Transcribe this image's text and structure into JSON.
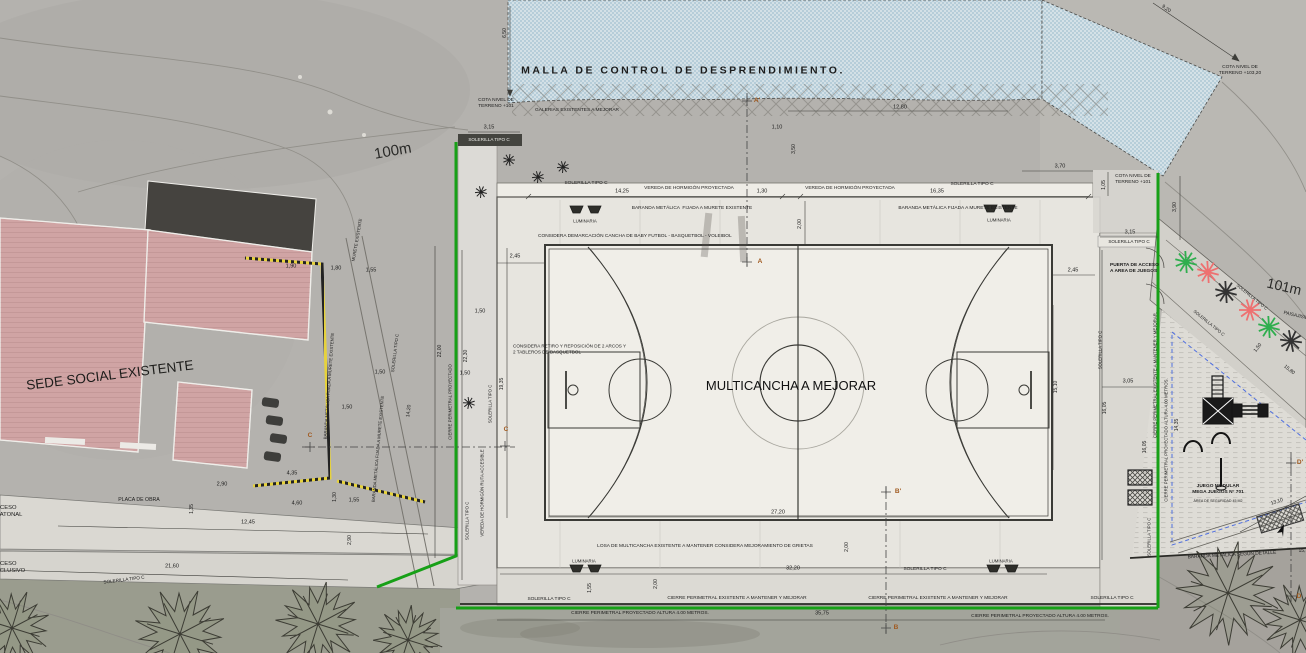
{
  "palette": {
    "background": "#b4b2ae",
    "mesh_blue": "#c6dde9",
    "gallery_orange": "#e1a544",
    "gallery_stripe": "#54431d",
    "court_surface": "#f0eee8",
    "platform": "#e7e5df",
    "concrete": "#dad8d2",
    "building_pink": "#d2a6a6",
    "roof_dark": "#45433f",
    "fence_green": "#17a017",
    "barrier_yellow": "#e6d23c",
    "safety_blue_dashed": "#4f6fe0",
    "plant_red": "#ee7070",
    "plant_green": "#2fae4e",
    "ink": "#1c1c1c",
    "section_marker": "#a05a20"
  },
  "labels": [
    {
      "id": "malla-title",
      "t": "MALLA DE CONTROL DE DESPRENDIMIENTO.",
      "x": 683,
      "y": 71,
      "s": 10.5,
      "b": 1,
      "ls": 2.5
    },
    {
      "id": "cota-terreno-101-left",
      "t": "COTA NIVEL DE\nTERRENO +101",
      "x": 496,
      "y": 104,
      "s": 4.8
    },
    {
      "id": "galerias-label",
      "t": "GALERIAS EXISTENTES A MEJORAR",
      "x": 577,
      "y": 111,
      "s": 4.8
    },
    {
      "id": "dim-3-15-left",
      "t": "3,15",
      "x": 489,
      "y": 128,
      "s": 5.5
    },
    {
      "id": "solerilla-band-top",
      "t": "SOLERILLA TIPO C",
      "x": 489,
      "y": 140,
      "s": 4.6,
      "c": "#eeeeea"
    },
    {
      "id": "dim-6-50",
      "t": "6,50",
      "x": 505,
      "y": 33,
      "r": -90,
      "s": 5
    },
    {
      "id": "dim-12-80",
      "t": "12,80",
      "x": 900,
      "y": 108,
      "s": 5.5
    },
    {
      "id": "dim-1-10",
      "t": "1,10",
      "x": 777,
      "y": 128,
      "s": 5.5
    },
    {
      "id": "dim-3-50",
      "t": "3,50",
      "x": 794,
      "y": 149,
      "r": -90,
      "s": 5
    },
    {
      "id": "solerilla-gal-left",
      "t": "SOLERILLA TIPO C",
      "x": 586,
      "y": 184,
      "s": 4.8
    },
    {
      "id": "dim-14-25",
      "t": "14,25",
      "x": 622,
      "y": 192,
      "s": 5.5
    },
    {
      "id": "vereda-left",
      "t": "VEREDA DE HORMIGÓN PROYECTADA",
      "x": 689,
      "y": 189,
      "s": 4.8
    },
    {
      "id": "dim-1-30-top",
      "t": "1,30",
      "x": 762,
      "y": 192,
      "s": 5.5
    },
    {
      "id": "vereda-right",
      "t": "VEREDA DE HORMIGÓN PROYECTADA",
      "x": 850,
      "y": 189,
      "s": 4.8
    },
    {
      "id": "dim-16-35",
      "t": "16,35",
      "x": 937,
      "y": 192,
      "s": 5.5
    },
    {
      "id": "solerilla-gal-right",
      "t": "SOLERILLA TIPO C",
      "x": 972,
      "y": 185,
      "s": 4.8
    },
    {
      "id": "dim-3-70",
      "t": "3,70",
      "x": 1060,
      "y": 167,
      "s": 5.5
    },
    {
      "id": "cota-terreno-101-right",
      "t": "COTA NIVEL DE\nTERRENO +101",
      "x": 1133,
      "y": 180,
      "s": 4.8
    },
    {
      "id": "dim-1-05",
      "t": "1,05",
      "x": 1104,
      "y": 185,
      "r": -90,
      "s": 5
    },
    {
      "id": "dim-3-90",
      "t": "3,90",
      "x": 1175,
      "y": 207,
      "r": -90,
      "s": 5
    },
    {
      "id": "cota-terreno-103",
      "t": "COTA NIVEL DE\nTERRENO +103,20",
      "x": 1240,
      "y": 71,
      "s": 4.8
    },
    {
      "id": "dim-9-20",
      "t": "9,20",
      "x": 1166,
      "y": 9,
      "r": 35,
      "s": 5
    },
    {
      "id": "dim-3-15-right",
      "t": "3,15",
      "x": 1130,
      "y": 233,
      "s": 5.5
    },
    {
      "id": "solerilla-band-right",
      "t": "SOLERILLA TIPO C",
      "x": 1129,
      "y": 242,
      "s": 4.6
    },
    {
      "id": "contour-label-100m",
      "t": "100m",
      "x": 393,
      "y": 152,
      "r": -10,
      "s": 15,
      "c": "#2a2a28"
    },
    {
      "id": "contour-label-101m",
      "t": "101m",
      "x": 1284,
      "y": 287,
      "r": 13,
      "s": 14,
      "c": "#2a2a28"
    },
    {
      "id": "baranda-top-left",
      "t": "BARANDA METÁLICA  FIJADA A MURETE EXISTENTE",
      "x": 692,
      "y": 209,
      "s": 4.8
    },
    {
      "id": "luminaria-top-left",
      "t": "LUMINARIA",
      "x": 585,
      "y": 221,
      "s": 4.3
    },
    {
      "id": "baranda-top-right",
      "t": "BARANDA METÁLICA FIJADA A MURETE EXISTENTE",
      "x": 958,
      "y": 209,
      "s": 4.8
    },
    {
      "id": "luminaria-top-right",
      "t": "LUMINARIA",
      "x": 999,
      "y": 220,
      "s": 4.3
    },
    {
      "id": "dim-2-00-top",
      "t": "2,00",
      "x": 800,
      "y": 224,
      "r": -90,
      "s": 5
    },
    {
      "id": "considera-demarcacion",
      "t": "CONSIDERA DEMARCACIÓN CANCHA DE BABY FUTBOL - BASQUETBOL - VOLEIBOL",
      "x": 538,
      "y": 237,
      "s": 4.8,
      "a": "left"
    },
    {
      "id": "dim-2-45-left",
      "t": "2,45",
      "x": 515,
      "y": 257,
      "s": 5.5
    },
    {
      "id": "dim-2-45-right",
      "t": "2,45",
      "x": 1073,
      "y": 271,
      "s": 5.5
    },
    {
      "id": "marker-a-top",
      "t": "A'",
      "x": 757,
      "y": 101,
      "s": 6.5,
      "c": "#a05a20",
      "b": 1
    },
    {
      "id": "marker-a-bottom",
      "t": "A",
      "x": 760,
      "y": 262,
      "s": 6.5,
      "c": "#a05a20",
      "b": 1
    },
    {
      "id": "considera-retiro",
      "t": "CONSIDERA RETIRO Y REPOSICIÓN DE 2 ARCOS Y\n2 TABLEROS DE BASQUETBOL",
      "x": 513,
      "y": 349,
      "s": 4.6,
      "a": "left"
    },
    {
      "id": "court-title",
      "t": "MULTICANCHA A MEJORAR",
      "x": 791,
      "y": 386,
      "s": 13,
      "c": "#111111"
    },
    {
      "id": "dim-19-35",
      "t": "19,35",
      "x": 502,
      "y": 384,
      "r": -90,
      "s": 5
    },
    {
      "id": "marker-c-left",
      "t": "C",
      "x": 310,
      "y": 436,
      "s": 6.5,
      "c": "#a05a20",
      "b": 1
    },
    {
      "id": "marker-c-right",
      "t": "C",
      "x": 506,
      "y": 430,
      "s": 6.5,
      "c": "#a05a20",
      "b": 1
    },
    {
      "id": "sede-social-label",
      "t": "SEDE SOCIAL EXISTENTE",
      "x": 110,
      "y": 376,
      "r": -7,
      "s": 13.5,
      "c": "#1c1c1a"
    },
    {
      "id": "placa-de-obra",
      "t": "PLACA DE OBRA",
      "x": 139,
      "y": 500,
      "s": 5.2
    },
    {
      "id": "dim-12-45",
      "t": "12,45",
      "x": 248,
      "y": 523,
      "s": 5.5
    },
    {
      "id": "acceso-peatonal",
      "t": "ACCESO\nPEATONAL",
      "x": -8,
      "y": 512,
      "s": 5.8,
      "a": "left"
    },
    {
      "id": "acceso-exclusivo",
      "t": "ACCESO\nEXCLUSIVO",
      "x": -8,
      "y": 568,
      "s": 5.8,
      "a": "left"
    },
    {
      "id": "dim-21-60",
      "t": "21,60",
      "x": 172,
      "y": 567,
      "s": 5.5
    },
    {
      "id": "solerilla-access-road",
      "t": "SOLERILLA TIPO C",
      "x": 124,
      "y": 580,
      "r": -7,
      "s": 4.6
    },
    {
      "id": "dim-2-90-v",
      "t": "2,90",
      "x": 350,
      "y": 540,
      "r": -90,
      "s": 5
    },
    {
      "id": "dim-2-90-h",
      "t": "2,90",
      "x": 222,
      "y": 485,
      "s": 5.5
    },
    {
      "id": "dim-4-35",
      "t": "4,35",
      "x": 292,
      "y": 474,
      "s": 5.5
    },
    {
      "id": "dim-4-60",
      "t": "4,60",
      "x": 297,
      "y": 504,
      "s": 5.5
    },
    {
      "id": "dim-1-55-road",
      "t": "1,55",
      "x": 354,
      "y": 501,
      "s": 5.5
    },
    {
      "id": "dim-1-30-v",
      "t": "1,30",
      "x": 335,
      "y": 497,
      "r": -90,
      "s": 5
    },
    {
      "id": "dim-1-35-v",
      "t": "1,35",
      "x": 192,
      "y": 509,
      "r": -90,
      "s": 5
    },
    {
      "id": "murete-existente",
      "t": "MURETE EXISTENTE",
      "x": 357,
      "y": 240,
      "r": -80,
      "s": 4.3
    },
    {
      "id": "dim-1-90",
      "t": "1,90",
      "x": 291,
      "y": 267,
      "s": 5.5
    },
    {
      "id": "dim-1-80",
      "t": "1,80",
      "x": 336,
      "y": 269,
      "s": 5.5
    },
    {
      "id": "dim-1-55-top",
      "t": "1,55",
      "x": 371,
      "y": 271,
      "s": 5.5
    },
    {
      "id": "baranda-left-1",
      "t": "BARANDA METÁLICA FIJADA A MURETE EXISTENTE",
      "x": 329,
      "y": 386,
      "r": -86,
      "s": 4.3
    },
    {
      "id": "baranda-left-2",
      "t": "BARANDA METÁLICA FIJADA A MURETE EXISTENTE",
      "x": 378,
      "y": 449,
      "r": -85,
      "s": 4.3
    },
    {
      "id": "dim-1-50-a",
      "t": "1,50",
      "x": 380,
      "y": 373,
      "s": 5.5
    },
    {
      "id": "dim-1-50-b",
      "t": "1,50",
      "x": 347,
      "y": 408,
      "s": 5.5
    },
    {
      "id": "dim-1-50-c",
      "t": "1,50",
      "x": 480,
      "y": 312,
      "s": 5.5
    },
    {
      "id": "dim-1-50-d",
      "t": "1,50",
      "x": 465,
      "y": 374,
      "s": 5.5
    },
    {
      "id": "solerilla-vert-a",
      "t": "SOLERILLA TIPO C",
      "x": 467,
      "y": 521,
      "r": -90,
      "s": 4.3
    },
    {
      "id": "solerilla-vert-b",
      "t": "SOLERILLA TIPO C",
      "x": 490,
      "y": 404,
      "r": -90,
      "s": 4.3
    },
    {
      "id": "vereda-ruta-accesible",
      "t": "VEREDA DE HORMIGÓN RUTA ACCESIBLE",
      "x": 482,
      "y": 493,
      "r": -90,
      "s": 4.3
    },
    {
      "id": "cierre-proyectado-left",
      "t": "CIERRE PERIMETRAL PROYECTADO",
      "x": 450,
      "y": 402,
      "r": -90,
      "s": 4.3
    },
    {
      "id": "dim-22-00",
      "t": "22,00",
      "x": 440,
      "y": 351,
      "r": -90,
      "s": 5
    },
    {
      "id": "dim-22-30",
      "t": "22,30",
      "x": 466,
      "y": 356,
      "r": -90,
      "s": 5
    },
    {
      "id": "dim-14-20",
      "t": "14,20",
      "x": 409,
      "y": 411,
      "r": -83,
      "s": 5
    },
    {
      "id": "solerilla-diag-left",
      "t": "SOLERILLA TIPO C",
      "x": 395,
      "y": 353,
      "r": -83,
      "s": 4.3
    },
    {
      "id": "losa-note",
      "t": "LOSA DE MULTICANCHA EXISTENTE A MANTENER CONSIDERA MEJORAMIENTO DE GRIETAS",
      "x": 705,
      "y": 547,
      "s": 4.8
    },
    {
      "id": "dim-27-20",
      "t": "27,20",
      "x": 778,
      "y": 513,
      "s": 5.5
    },
    {
      "id": "dim-2-00-right",
      "t": "2,00",
      "x": 847,
      "y": 547,
      "r": -90,
      "s": 5
    },
    {
      "id": "luminaria-bottom-left",
      "t": "LUMINARIA",
      "x": 584,
      "y": 561,
      "s": 4.3
    },
    {
      "id": "luminaria-bottom-right",
      "t": "LUMINARIA",
      "x": 1001,
      "y": 561,
      "s": 4.3
    },
    {
      "id": "dim-32-20",
      "t": "32,20",
      "x": 793,
      "y": 569,
      "s": 5.5
    },
    {
      "id": "solerilla-bottom-left",
      "t": "SOLERILLA TIPO C",
      "x": 549,
      "y": 600,
      "s": 4.8
    },
    {
      "id": "dim-1-55-bottom",
      "t": "1,55",
      "x": 590,
      "y": 588,
      "r": -90,
      "s": 5
    },
    {
      "id": "dim-2-00-bottom",
      "t": "2,00",
      "x": 656,
      "y": 584,
      "r": -90,
      "s": 5
    },
    {
      "id": "cierre-existente-1",
      "t": "CIERRE PERIMETRAL EXISTENTE A MANTENER Y MEJORAR",
      "x": 737,
      "y": 599,
      "s": 4.8
    },
    {
      "id": "cierre-existente-2",
      "t": "CIERRE PERIMETRAL EXISTENTE A MANTENER Y MEJORAR",
      "x": 938,
      "y": 599,
      "s": 4.8
    },
    {
      "id": "cierre-proyectado-1",
      "t": "CIERRE PERIMETRAL PROYECTADO ALTURA 4.00 METROS.",
      "x": 640,
      "y": 614,
      "s": 4.8
    },
    {
      "id": "dim-35-75",
      "t": "35,75",
      "x": 822,
      "y": 614,
      "s": 5.5
    },
    {
      "id": "cierre-proyectado-2",
      "t": "CIERRE PERIMETRAL PROYECTADO ALTURA 4.00 METROS.",
      "x": 1040,
      "y": 617,
      "s": 4.8
    },
    {
      "id": "solerilla-bottom-mid",
      "t": "SOLERILLA TIPO C",
      "x": 925,
      "y": 570,
      "s": 4.8
    },
    {
      "id": "solerilla-bottom-right",
      "t": "SOLERILLA TIPO C",
      "x": 1112,
      "y": 599,
      "s": 4.8
    },
    {
      "id": "marker-b-top",
      "t": "B'",
      "x": 898,
      "y": 492,
      "s": 6.5,
      "c": "#a05a20",
      "b": 1
    },
    {
      "id": "marker-b-bottom",
      "t": "B",
      "x": 896,
      "y": 628,
      "s": 6.5,
      "c": "#a05a20",
      "b": 1
    },
    {
      "id": "solerilla-vert-right-a",
      "t": "SOLERILLA TIPO C",
      "x": 1100,
      "y": 350,
      "r": -90,
      "s": 4.3
    },
    {
      "id": "dim-3-05",
      "t": "3,05",
      "x": 1128,
      "y": 382,
      "s": 5.5
    },
    {
      "id": "dim-16-05-a",
      "t": "16,05",
      "x": 1105,
      "y": 408,
      "r": -90,
      "s": 5
    },
    {
      "id": "dim-16-05-b",
      "t": "16,05",
      "x": 1145,
      "y": 447,
      "r": -90,
      "s": 5
    },
    {
      "id": "dim-15-10",
      "t": "15,10",
      "x": 1056,
      "y": 387,
      "r": -90,
      "s": 5
    },
    {
      "id": "puerta-acceso",
      "t": "PUERTA DE ACCESO\nA AREA DE JUEGOS",
      "x": 1110,
      "y": 269,
      "s": 4.8,
      "a": "left",
      "b": 1
    },
    {
      "id": "cierre-existente-vert",
      "t": "CIERRE PERIMETRAL EXISTENTE A MANTENER Y MEJORAR.",
      "x": 1155,
      "y": 375,
      "r": -90,
      "s": 4.3
    },
    {
      "id": "cierre-proyectado-vert",
      "t": "CIERRE PERIMETRAL PROYECTADO ALTURA 4.00 METROS.",
      "x": 1166,
      "y": 440,
      "r": -90,
      "s": 4.3
    },
    {
      "id": "dim-14-35",
      "t": "14,35",
      "x": 1177,
      "y": 425,
      "r": -90,
      "s": 5
    },
    {
      "id": "solerilla-vert-right-b",
      "t": "SOLERILLA TIPO C",
      "x": 1149,
      "y": 537,
      "r": -90,
      "s": 4.3
    },
    {
      "id": "solerilla-path-1",
      "t": "SOLERILLA TIPO C",
      "x": 1252,
      "y": 297,
      "r": 39,
      "s": 4.3
    },
    {
      "id": "solerilla-path-2",
      "t": "SOLERILLA TIPO C",
      "x": 1209,
      "y": 323,
      "r": 39,
      "s": 4.3
    },
    {
      "id": "paisajismo",
      "t": "PAISAJISMO",
      "x": 1283,
      "y": 317,
      "r": 13,
      "s": 4.8,
      "a": "left"
    },
    {
      "id": "dim-1-50-path",
      "t": "1,50",
      "x": 1258,
      "y": 348,
      "r": -52,
      "s": 5
    },
    {
      "id": "dim-15-80",
      "t": "15,80",
      "x": 1289,
      "y": 370,
      "r": 39,
      "s": 5
    },
    {
      "id": "juego-modular",
      "t": "JUEGO MODULAR\nMEGA JUEGOS N° 701",
      "x": 1218,
      "y": 490,
      "s": 4.8,
      "b": 1
    },
    {
      "id": "juego-area-seguridad",
      "t": "ÁREA DE SEGURIDAD 45 M2",
      "x": 1218,
      "y": 501,
      "s": 3.6
    },
    {
      "id": "dim-13-10",
      "t": "13,10",
      "x": 1277,
      "y": 502,
      "r": -18,
      "s": 5
    },
    {
      "id": "baranda-segun-detalle",
      "t": "BARANDA METÁLICA SEGÚN DETALLE",
      "x": 1232,
      "y": 556,
      "r": -3,
      "s": 4.8
    },
    {
      "id": "dim-15-cut",
      "t": "15,",
      "x": 1302,
      "y": 551,
      "r": -3,
      "s": 5
    },
    {
      "id": "marker-d-top",
      "t": "D'",
      "x": 1300,
      "y": 463,
      "s": 6.5,
      "c": "#a05a20",
      "b": 1
    },
    {
      "id": "marker-d-bottom",
      "t": "D",
      "x": 1299,
      "y": 597,
      "s": 6.5,
      "c": "#a05a20",
      "b": 1
    }
  ],
  "vegetation": {
    "trees": [
      {
        "x": 180,
        "y": 634,
        "rad": 48
      },
      {
        "x": 318,
        "y": 624,
        "rad": 44
      },
      {
        "x": 408,
        "y": 640,
        "rad": 36
      },
      {
        "x": 12,
        "y": 628,
        "rad": 40
      },
      {
        "x": 1228,
        "y": 593,
        "rad": 54
      },
      {
        "x": 1300,
        "y": 620,
        "rad": 40
      }
    ],
    "shrubs": [
      [
        509,
        160
      ],
      [
        538,
        177
      ],
      [
        481,
        192
      ],
      [
        469,
        403
      ],
      [
        563,
        167
      ]
    ],
    "path_plants": [
      {
        "x": 1186,
        "y": 262,
        "c": "green"
      },
      {
        "x": 1208,
        "y": 272,
        "c": "red"
      },
      {
        "x": 1226,
        "y": 292,
        "c": "dark"
      },
      {
        "x": 1250,
        "y": 310,
        "c": "red"
      },
      {
        "x": 1269,
        "y": 327,
        "c": "green"
      },
      {
        "x": 1291,
        "y": 341,
        "c": "dark"
      }
    ]
  },
  "luminarias": [
    [
      570,
      206
    ],
    [
      588,
      206
    ],
    [
      984,
      205
    ],
    [
      1002,
      205
    ],
    [
      570,
      565
    ],
    [
      588,
      565
    ],
    [
      987,
      565
    ],
    [
      1005,
      565
    ]
  ]
}
